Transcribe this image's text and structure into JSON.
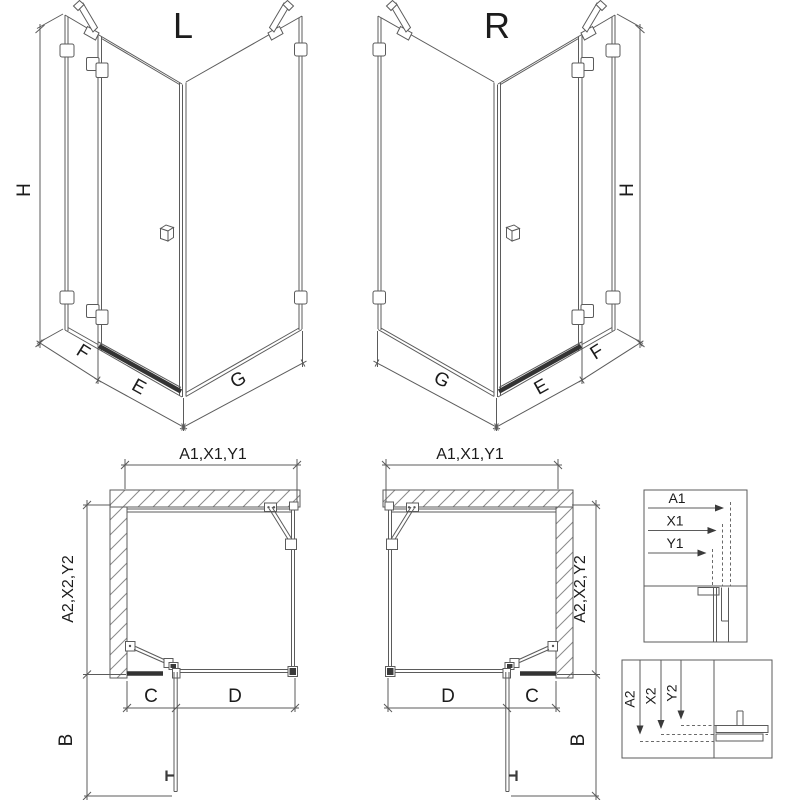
{
  "colors": {
    "line": "#5b5b5b",
    "dark_bar": "#333333",
    "text": "#1c1c1c",
    "background": "#ffffff"
  },
  "iso_left": {
    "title": "L",
    "dim_height": "H",
    "dim_side_panel": "F",
    "dim_door": "E",
    "dim_return_panel": "G"
  },
  "iso_right": {
    "title": "R",
    "dim_height": "H",
    "dim_side_panel": "F",
    "dim_door": "E",
    "dim_return_panel": "G"
  },
  "plan_left": {
    "dim_top": "A1,X1,Y1",
    "dim_side": "A2,X2,Y2",
    "dim_door_section": "C",
    "dim_fixed_section": "D",
    "dim_door_open": "B"
  },
  "plan_right": {
    "dim_top": "A1,X1,Y1",
    "dim_side": "A2,X2,Y2",
    "dim_door_section": "C",
    "dim_fixed_section": "D",
    "dim_door_open": "B"
  },
  "detail_width": {
    "labels": [
      "A1",
      "X1",
      "Y1"
    ]
  },
  "detail_depth": {
    "labels": [
      "A2",
      "X2",
      "Y2"
    ]
  }
}
